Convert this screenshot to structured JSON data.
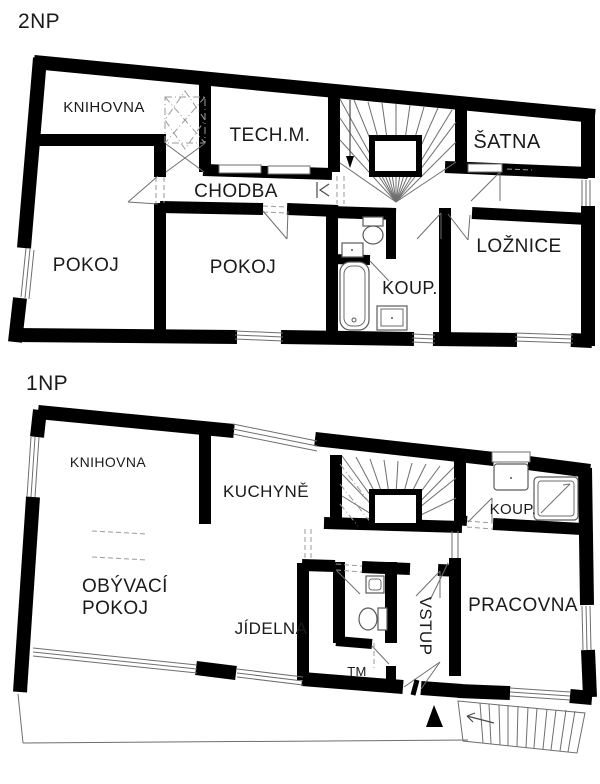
{
  "colors": {
    "background": "#ffffff",
    "wall": "#000000",
    "thin_line": "#6e6e6e",
    "dashed_line": "#9a9a9a",
    "text": "#1a1a1a"
  },
  "floors": [
    {
      "id": "2NP",
      "title": "2NP",
      "rooms": [
        {
          "label": "KNIHOVNA"
        },
        {
          "label": "TECH.M."
        },
        {
          "label": "ŠATNA"
        },
        {
          "label": "CHODBA"
        },
        {
          "label": "POKOJ"
        },
        {
          "label": "POKOJ"
        },
        {
          "label": "KOUP."
        },
        {
          "label": "LOŽNICE"
        }
      ],
      "features": [
        "u-staircase-down-arrow",
        "dashed-skylight-library",
        "toilet",
        "wash-basin",
        "bathtub",
        "windows",
        "door-swings"
      ]
    },
    {
      "id": "1NP",
      "title": "1NP",
      "rooms": [
        {
          "label": "KNIHOVNA"
        },
        {
          "label": "KUCHYNĚ"
        },
        {
          "label": "KOUP."
        },
        {
          "label": "OBÝVACÍ POKOJ",
          "line1": "OBÝVACÍ",
          "line2": "POKOJ"
        },
        {
          "label": "JÍDELNA"
        },
        {
          "label": "VSTUP"
        },
        {
          "label": "PRACOVNA"
        },
        {
          "label": "TM"
        }
      ],
      "features": [
        "u-staircase",
        "shower",
        "toilet",
        "wash-basin",
        "entrance-triangle",
        "exterior-stairs",
        "terrace-outline",
        "glass-south-wall",
        "windows",
        "door-swings"
      ]
    }
  ]
}
